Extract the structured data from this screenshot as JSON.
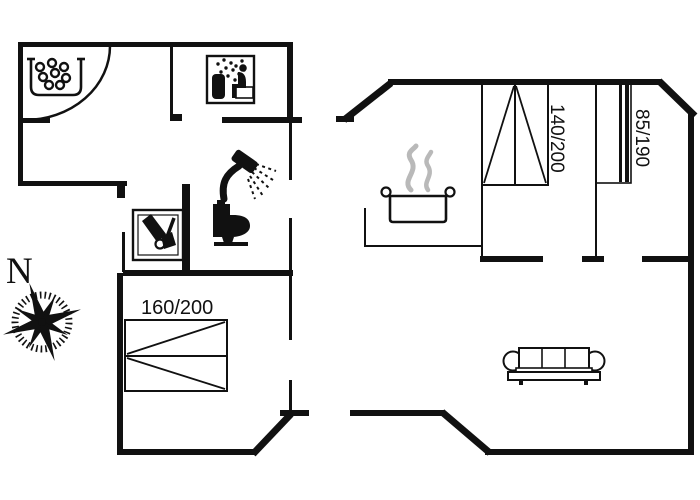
{
  "colors": {
    "background": "#ffffff",
    "walls": "#111111",
    "steam": "#b9b9b9",
    "text": "#111111"
  },
  "compass": {
    "north_label": "N"
  },
  "bed_labels": {
    "bedroom_left_double": "160/200",
    "bedroom_top_double": "140/200",
    "bedroom_right_single": "85/190"
  },
  "icons": [
    {
      "name": "whirlpool-icon",
      "meaning": "whirlpool / bubble bath tub with bubbles"
    },
    {
      "name": "sauna-icon",
      "meaning": "person seated in sauna with steam"
    },
    {
      "name": "shower-icon",
      "meaning": "shower head with spray"
    },
    {
      "name": "toilet-icon",
      "meaning": "toilet silhouette"
    },
    {
      "name": "garden-tools-icon",
      "meaning": "boxed wheelbarrow and spade tools"
    },
    {
      "name": "cooking-pot-icon",
      "meaning": "steaming cooking pot (kitchen)"
    },
    {
      "name": "sofa-icon",
      "meaning": "three-seat sofa (living room)"
    },
    {
      "name": "compass-rose",
      "meaning": "compass rose pointing north"
    },
    {
      "name": "door-arc",
      "meaning": "entrance door swing arc"
    }
  ]
}
